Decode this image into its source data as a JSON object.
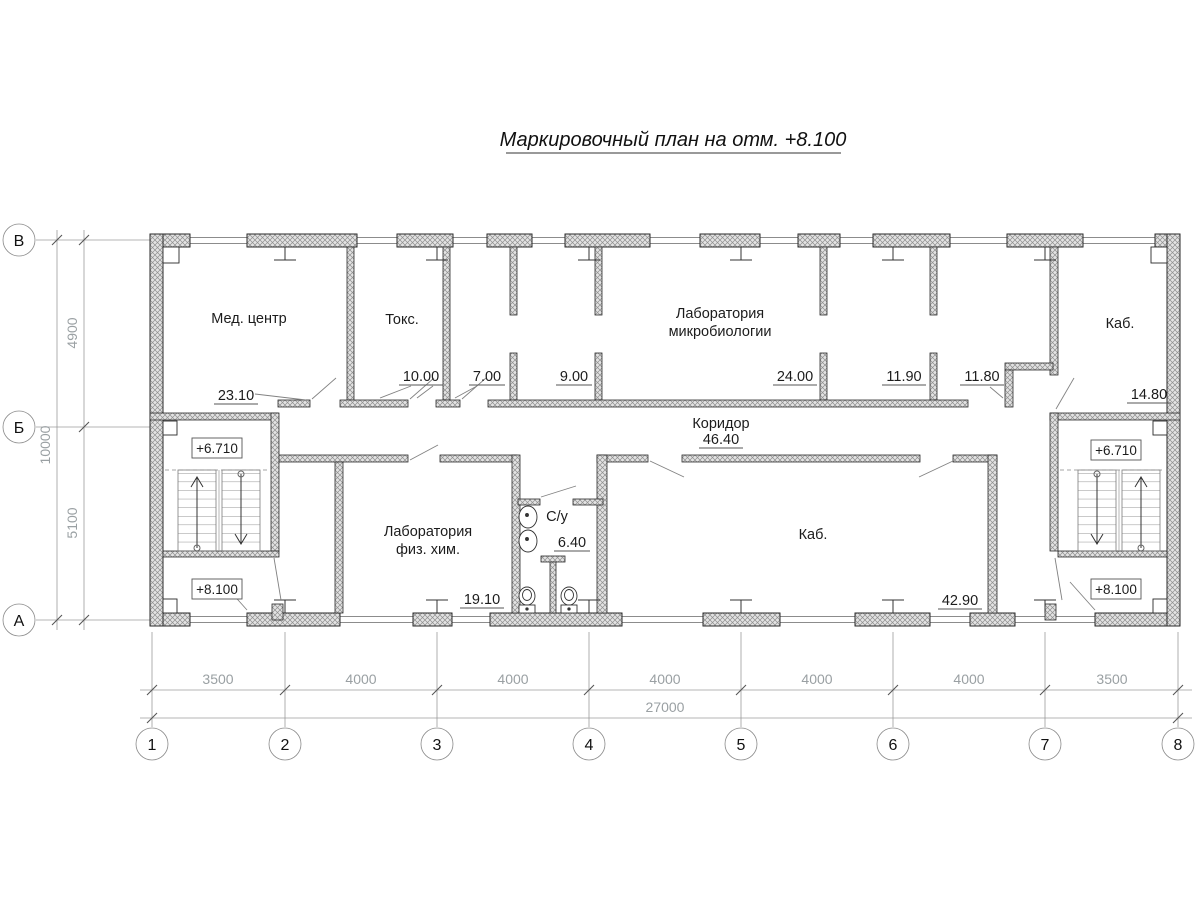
{
  "title": "Маркировочный план на отм. +8.100",
  "axes": {
    "rows": [
      "В",
      "Б",
      "А"
    ],
    "cols": [
      "1",
      "2",
      "3",
      "4",
      "5",
      "6",
      "7",
      "8"
    ]
  },
  "dims": {
    "bays": [
      "3500",
      "4000",
      "4000",
      "4000",
      "4000",
      "4000",
      "3500"
    ],
    "total": "27000",
    "left_upper": "4900",
    "left_lower": "5100",
    "left_total": "10000"
  },
  "rooms": {
    "med_center": {
      "name": "Мед. центр",
      "area": "23.10"
    },
    "toks": {
      "name": "Токс.",
      "area": "10.00"
    },
    "r7": {
      "area": "7.00"
    },
    "r9": {
      "area": "9.00"
    },
    "lab_micro": {
      "name1": "Лаборатория",
      "name2": "микробиологии",
      "area": "24.00"
    },
    "r1190": {
      "area": "11.90"
    },
    "r1180": {
      "area": "11.80"
    },
    "kab_top": {
      "name": "Каб.",
      "area": "14.80"
    },
    "koridor": {
      "name": "Коридор",
      "area": "46.40"
    },
    "lab_fiz": {
      "name1": "Лаборатория",
      "name2": "физ. хим.",
      "area": "19.10"
    },
    "su": {
      "name": "С/у",
      "area": "6.40"
    },
    "kab_big": {
      "name": "Каб.",
      "area": "42.90"
    }
  },
  "elevations": {
    "upper": "+6.710",
    "lower": "+8.100"
  },
  "colors": {
    "line": "#2a2a2a",
    "dim": "#9aa0a3",
    "wall_fill": "#e3e3e3",
    "hatch": "#8f8f8f"
  }
}
